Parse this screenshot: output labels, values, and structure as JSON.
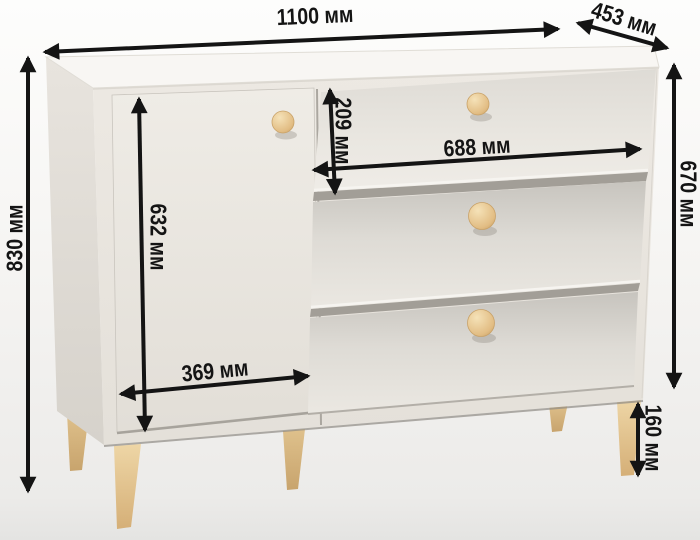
{
  "figure": {
    "kind": "furniture-dimension-diagram",
    "unit": "мм",
    "annotation_color": "#141414"
  },
  "dimensions": {
    "overall_width": {
      "value": 1100,
      "label": "1100 мм"
    },
    "depth": {
      "value": 453,
      "label": "453 мм"
    },
    "overall_height": {
      "value": 830,
      "label": "830 мм"
    },
    "body_height": {
      "value": 670,
      "label": "670 мм"
    },
    "door_height": {
      "value": 632,
      "label": "632 мм"
    },
    "top_drawer_height": {
      "value": 209,
      "label": "209 мм"
    },
    "drawer_width": {
      "value": 688,
      "label": "688 мм"
    },
    "door_width": {
      "value": 369,
      "label": "369 мм"
    },
    "leg_height": {
      "value": 160,
      "label": "160 мм"
    }
  },
  "colors": {
    "background": "#f4f3f1",
    "cabinet_body": "#ece8e2",
    "cabinet_top": "#f8f6f3",
    "knob_wood": "#e8c48d",
    "leg_wood": "#e3c38f",
    "shadow_gap": "#a29e97"
  }
}
